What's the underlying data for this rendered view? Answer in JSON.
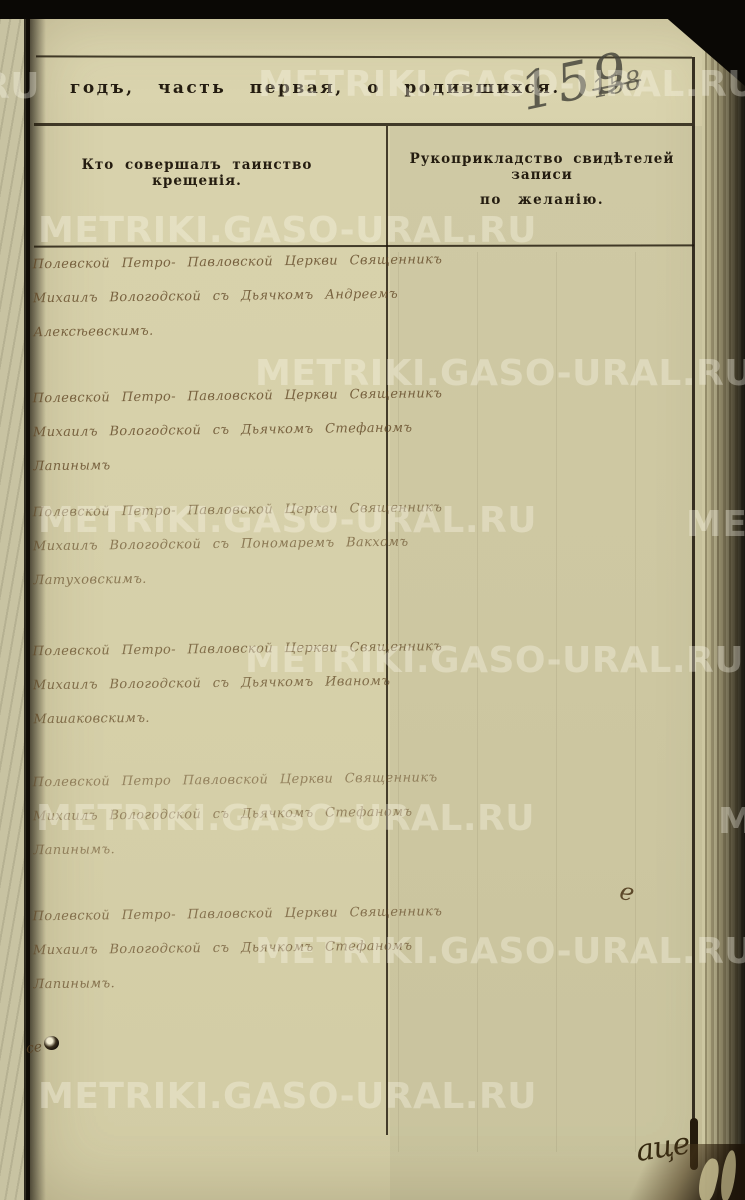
{
  "watermark": {
    "text": "METRIKI.GASO-URAL.RU",
    "tail_ru": "RU",
    "tile_me": "ME"
  },
  "header": {
    "title": "годъ, часть первая, о родившихся.",
    "page_number": "159",
    "page_number_crossed_out": "158"
  },
  "table": {
    "left_column_header": "Кто совершалъ таинство крещенія.",
    "right_column_header_line1": "Рукоприкладство свидѣтелей записи",
    "right_column_header_line2": "по желанію."
  },
  "entries": [
    {
      "lines": [
        "Полевской Петро- Павловской Церкви Священникъ",
        "Михаилъ Вологодской съ Дьячкомъ Андреемъ",
        "Алексѣевскимъ."
      ]
    },
    {
      "lines": [
        "Полевской Петро- Павловской Церкви Священникъ",
        "Михаилъ Вологодской съ Дьячкомъ Стефаномъ",
        "Лапинымъ"
      ]
    },
    {
      "lines": [
        "Полевской Петро- Павловской Церкви Священникъ",
        "Михаилъ Вологодской съ Пономаремъ Вакхомъ",
        "Латуховскимъ."
      ]
    },
    {
      "lines": [
        "Полевской Петро- Павловской Церкви Священникъ",
        "Михаилъ Вологодской съ Дьячкомъ Иваномъ",
        "Машаковскимъ."
      ]
    },
    {
      "lines": [
        "Полевской Петро Павловской Церкви Священникъ",
        "Михаилъ Вологодской съ Дьячкомъ Стефаномъ",
        "Лапинымъ."
      ]
    },
    {
      "lines": [
        "Полевской Петро- Павловской Церкви Священникъ",
        "Михаилъ Вологодской съ Дьячкомъ Стефаномъ",
        "Лапинымъ."
      ]
    }
  ],
  "annotations": {
    "right_column_mark": "е",
    "margin_mark": "се",
    "corner_signature": "аце"
  },
  "colors": {
    "paper": "#d6d0a9",
    "printed_ink": "#241c10",
    "handwriting_ink": "#604624",
    "watermark": "#fffcf0"
  }
}
